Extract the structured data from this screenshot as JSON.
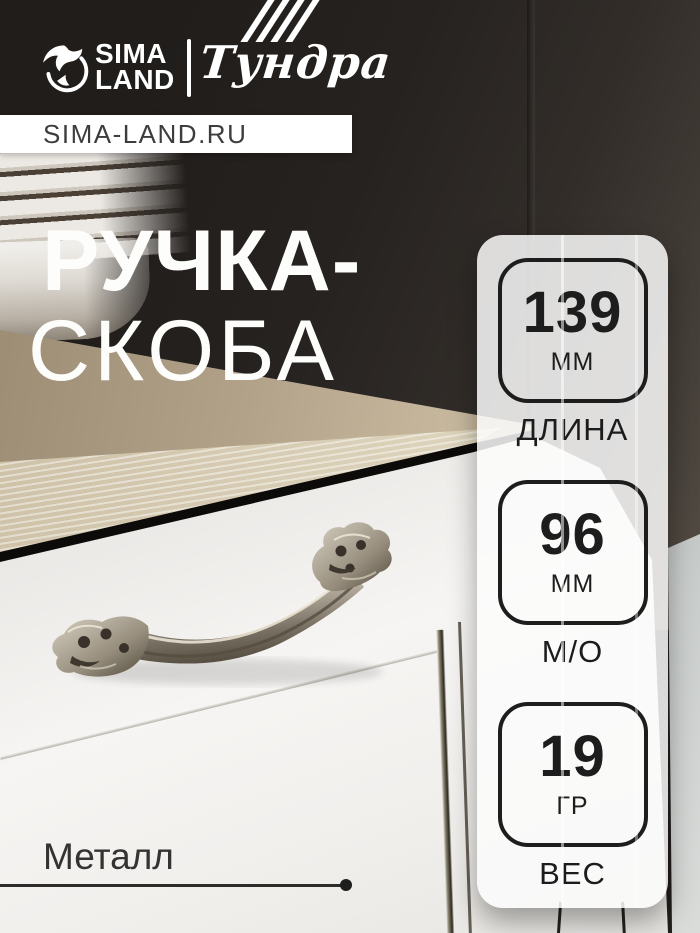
{
  "header": {
    "brand_sima": {
      "line1": "SIMA",
      "line2": "LAND"
    },
    "brand_tundra": "Тундра",
    "site_bar": "SIMA-LAND.RU"
  },
  "title": {
    "line1": "РУЧКА-",
    "line2": "СКОБА"
  },
  "specs": [
    {
      "value": "139",
      "unit": "ММ",
      "label": "ДЛИНА"
    },
    {
      "value": "96",
      "unit": "ММ",
      "label": "М/О"
    },
    {
      "value": "19",
      "unit": "ГР",
      "label": "ВЕС"
    }
  ],
  "material": {
    "label": "Металл"
  },
  "colors": {
    "badge_outline": "#1d1d1d",
    "panel_bg": "rgba(252,252,252,0.85)",
    "countertop_gold": "#b5a06e",
    "brand_white": "#ffffff"
  }
}
